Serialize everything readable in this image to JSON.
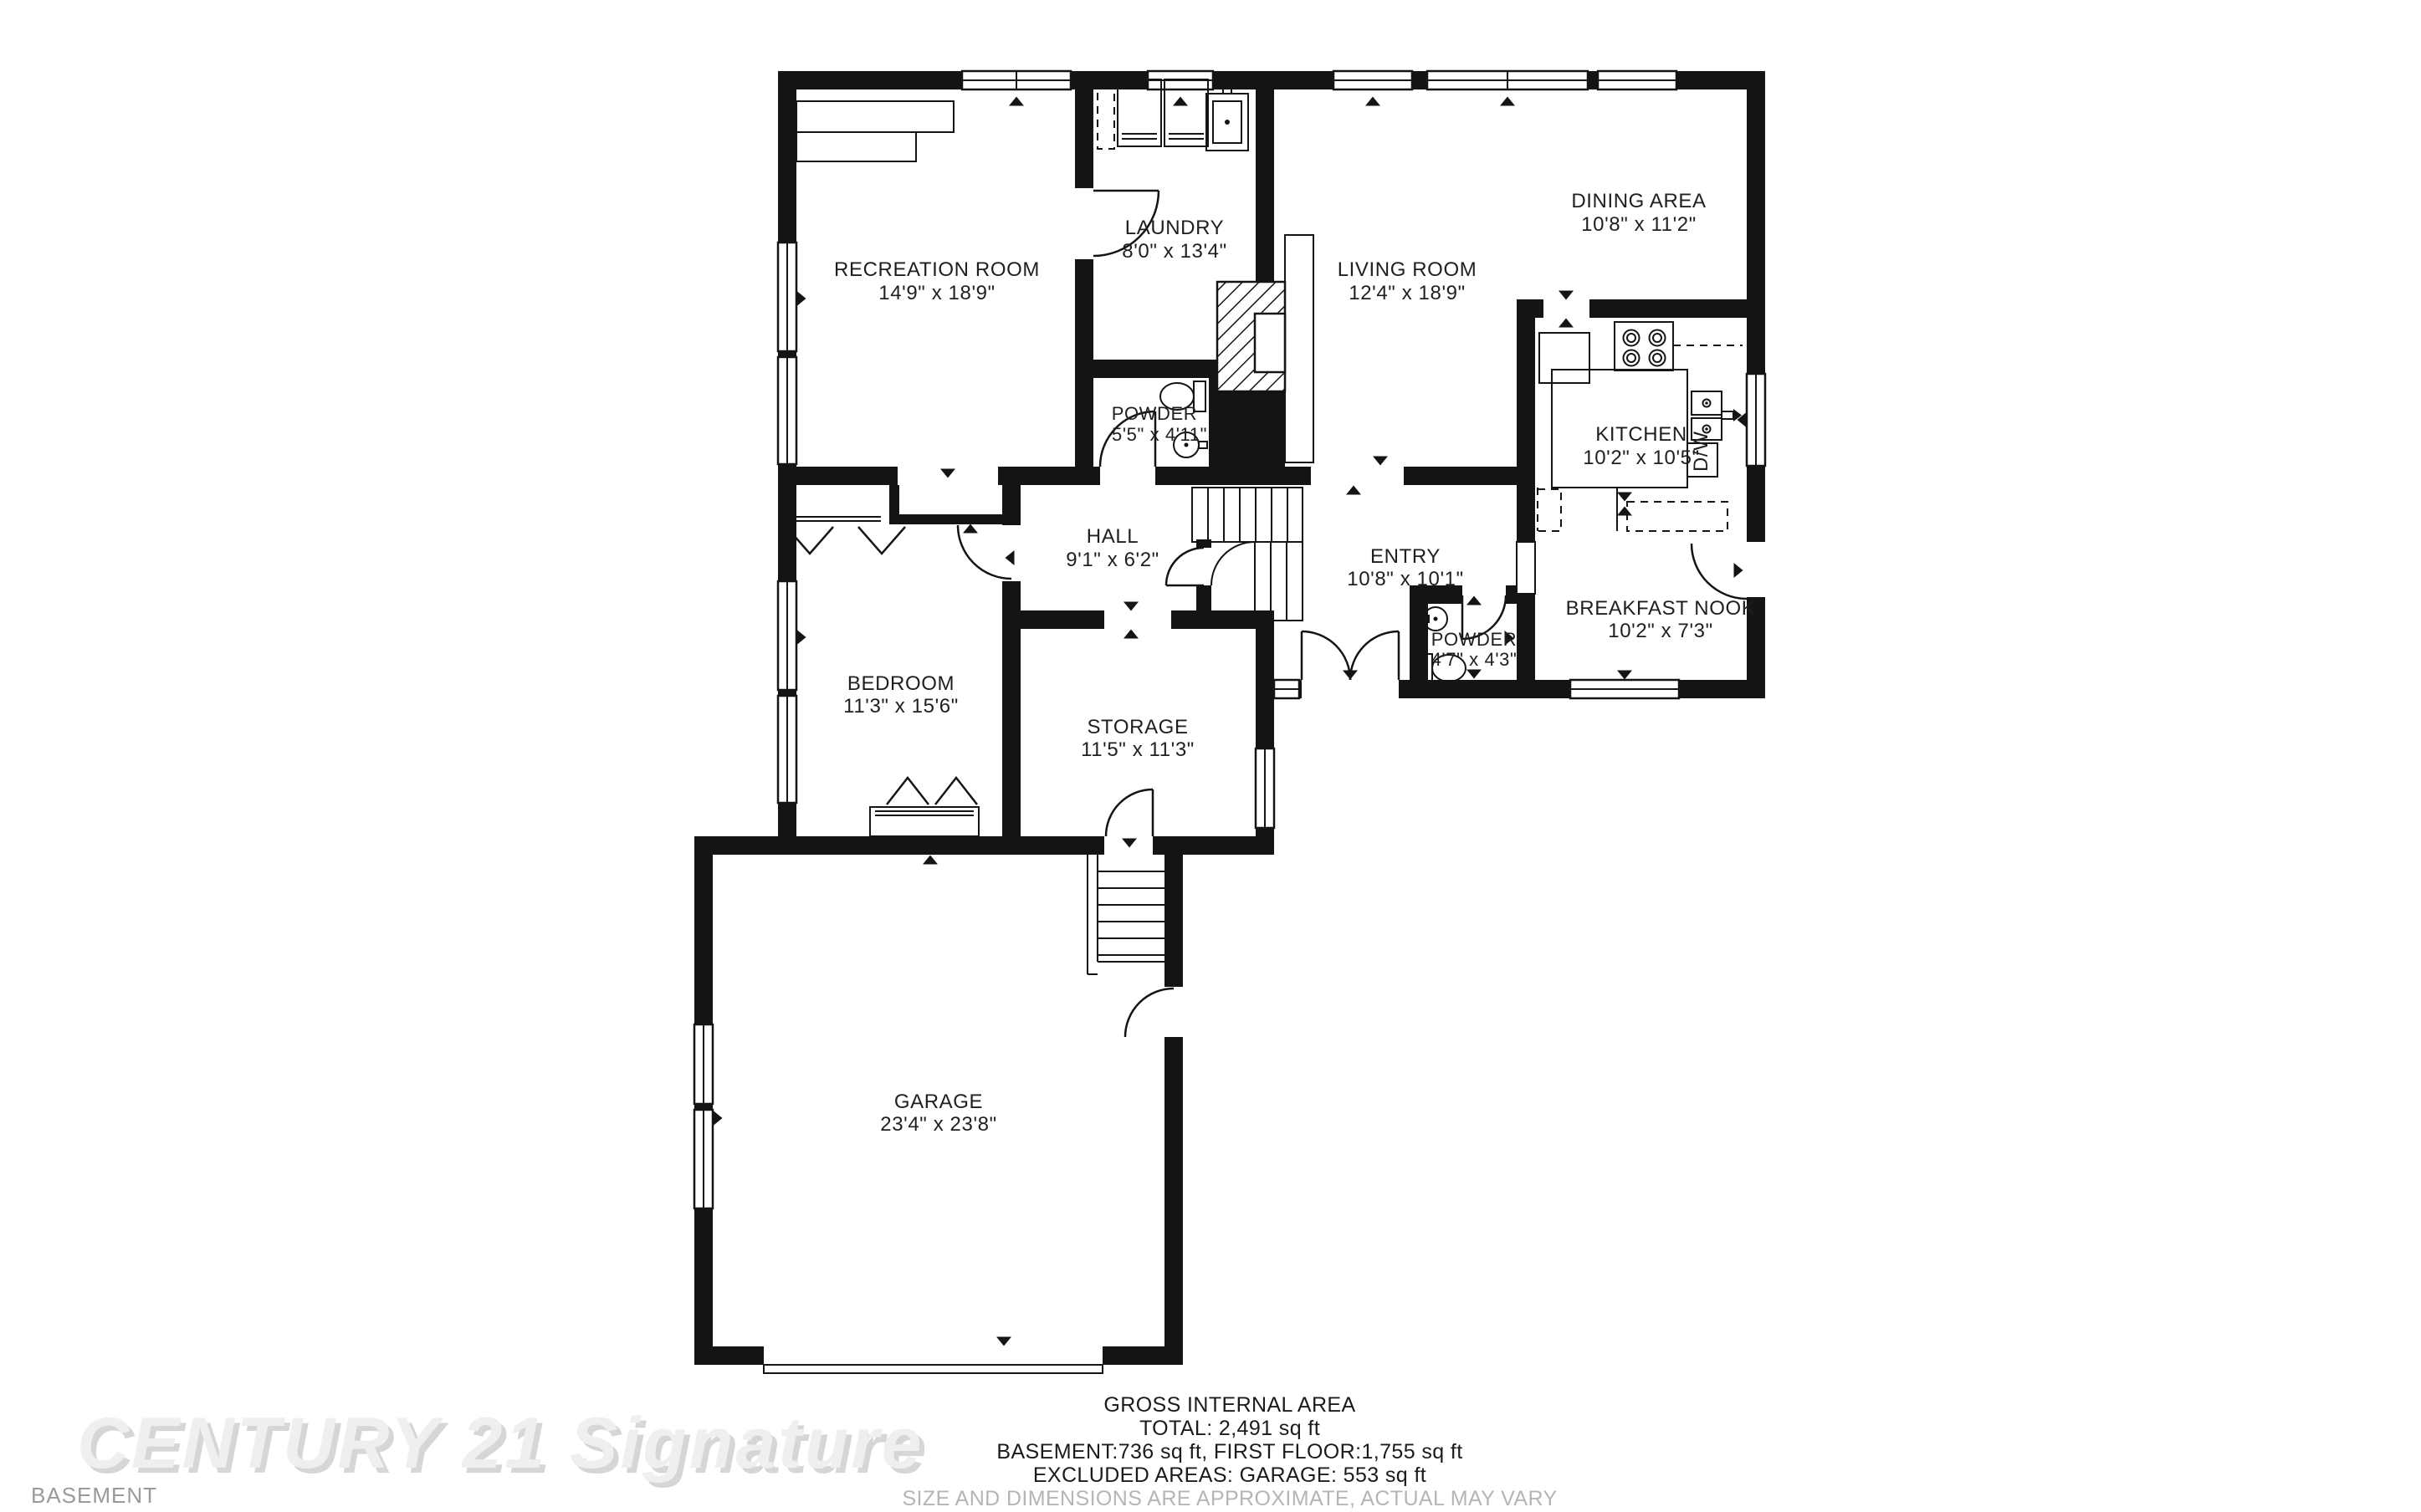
{
  "floor_label": "BASEMENT",
  "watermark": "CENTURY 21 Signature",
  "rooms": {
    "recreation": {
      "name": "RECREATION ROOM",
      "dims": "14'9\" x 18'9\""
    },
    "laundry": {
      "name": "LAUNDRY",
      "dims": "8'0\" x 13'4\""
    },
    "living": {
      "name": "LIVING ROOM",
      "dims": "12'4\" x 18'9\""
    },
    "dining": {
      "name": "DINING AREA",
      "dims": "10'8\" x 11'2\""
    },
    "kitchen": {
      "name": "KITCHEN",
      "dims": "10'2\" x 10'5\""
    },
    "powder_basement": {
      "name": "POWDER",
      "dims": "5'5\" x 4'11\""
    },
    "hall": {
      "name": "HALL",
      "dims": "9'1\" x 6'2\""
    },
    "entry": {
      "name": "ENTRY",
      "dims": "10'8\" x 10'1\""
    },
    "breakfast_nook": {
      "name": "BREAKFAST NOOK",
      "dims": "10'2\" x 7'3\""
    },
    "powder_first": {
      "name": "POWDER",
      "dims": "4'7\" x 4'3\""
    },
    "bedroom": {
      "name": "BEDROOM",
      "dims": "11'3\" x 15'6\""
    },
    "storage": {
      "name": "STORAGE",
      "dims": "11'5\" x 11'3\""
    },
    "garage": {
      "name": "GARAGE",
      "dims": "23'4\" x 23'8\""
    }
  },
  "fixtures": {
    "dishwasher": "D/W"
  },
  "summary": {
    "title": "GROSS INTERNAL AREA",
    "total": "TOTAL: 2,491 sq ft",
    "floors": "BASEMENT:736 sq ft, FIRST FLOOR:1,755 sq ft",
    "excluded": "EXCLUDED AREAS: GARAGE: 553 sq ft",
    "disclaimer": "SIZE AND DIMENSIONS ARE APPROXIMATE, ACTUAL MAY VARY"
  }
}
